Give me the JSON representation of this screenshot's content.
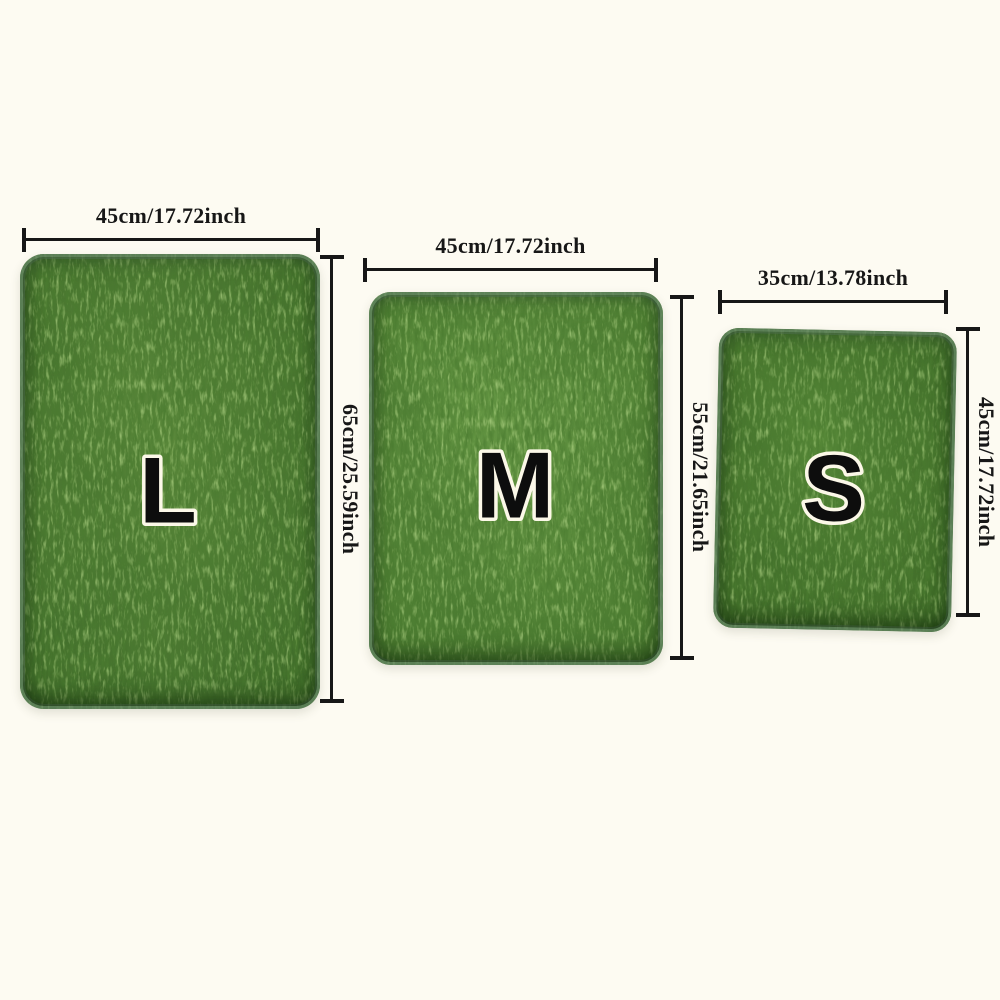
{
  "page": {
    "background_color": "#fdfbf2",
    "dimension_line_color": "#171717"
  },
  "sizes": [
    {
      "letter": "L",
      "width_label": "45cm/17.72inch",
      "height_label": "65cm/25.59inch",
      "color_light": "#5e8c3d",
      "color_base": "#3e6a29"
    },
    {
      "letter": "M",
      "width_label": "45cm/17.72inch",
      "height_label": "55cm/21.65inch",
      "color_light": "#6b9d48",
      "color_base": "#4a7a30"
    },
    {
      "letter": "S",
      "width_label": "35cm/13.78inch",
      "height_label": "45cm/17.72inch",
      "color_light": "#5a8c3a",
      "color_base": "#3d6827"
    }
  ],
  "letter_style": {
    "fill": "#0d0d0d",
    "outline": "#fcf8e8"
  }
}
